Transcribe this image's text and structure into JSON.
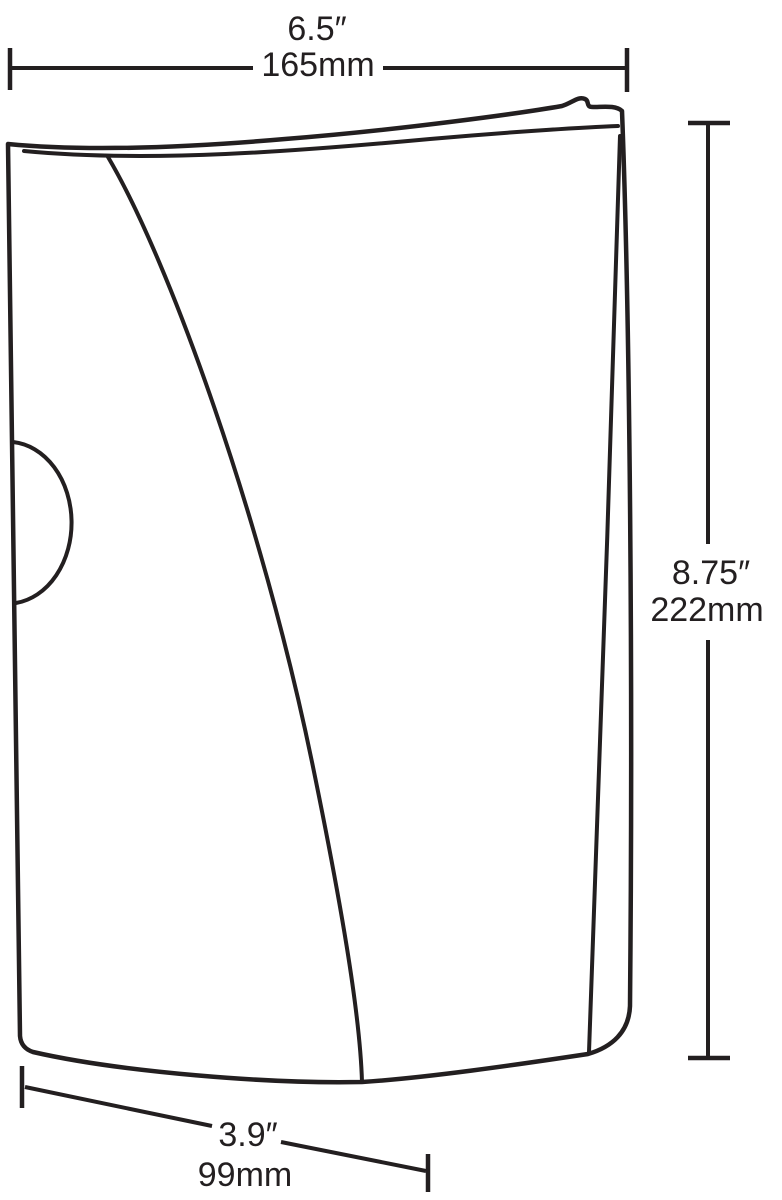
{
  "figure": {
    "type": "technical-line-drawing",
    "subject": "wall-mounted product with curved front cover, side notch and dimension callouts"
  },
  "colors": {
    "line": "#231f20",
    "text": "#231f20",
    "background": "#ffffff"
  },
  "dimensions": {
    "width": {
      "inches": "6.5″",
      "mm": "165mm"
    },
    "height": {
      "inches": "8.75″",
      "mm": "222mm"
    },
    "depth": {
      "inches": "3.9″",
      "mm": "99mm"
    }
  }
}
